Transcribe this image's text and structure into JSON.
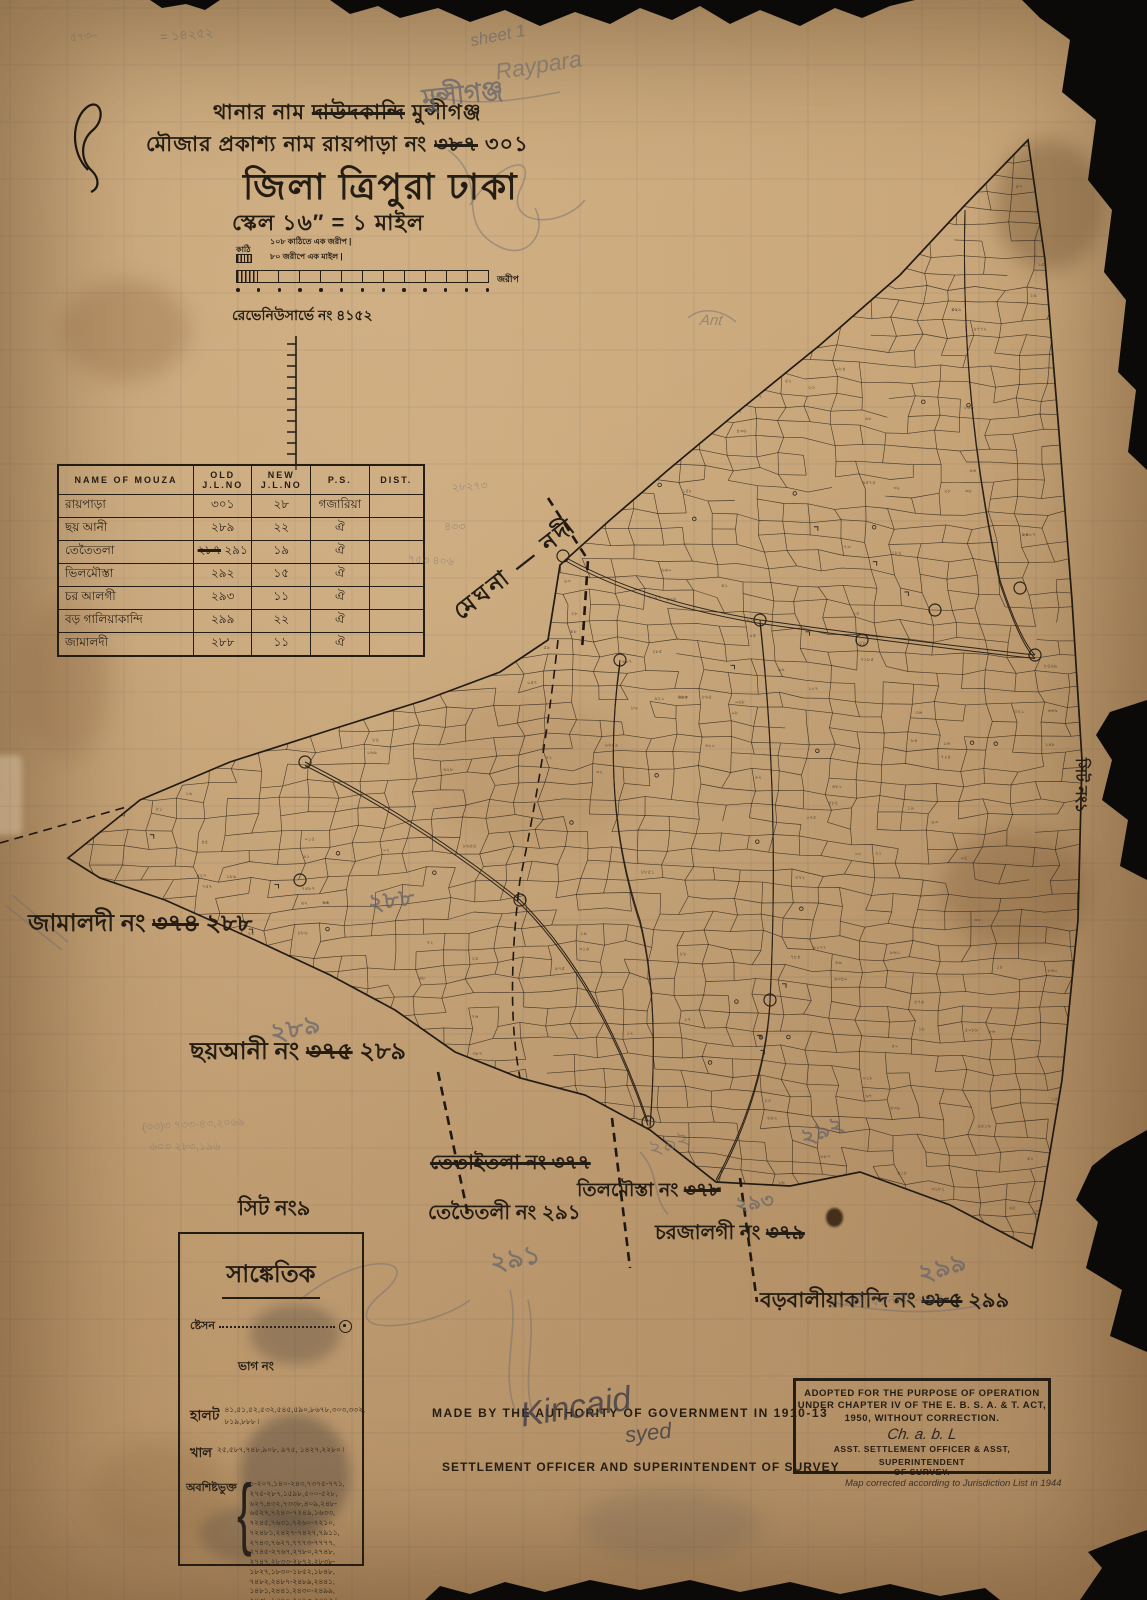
{
  "colors": {
    "paper": "#c9a77a",
    "ink": "#241d14",
    "pencil": "#63646c",
    "torn_edge": "#0b0a08"
  },
  "header": {
    "line1_prefix": "থানার নাম",
    "line1_struck": "দাউদকান্দি",
    "line1_suffix": "মুন্সীগঞ্জ",
    "line2_prefix": "মৌজার প্রকাশ্য নাম  রায়পাড়া নং",
    "line2_struck": "৩৮৭",
    "line2_suffix": "৩০১",
    "line3_prefix": "জিলা",
    "line3_mid": "ত্রিপুরা",
    "line3_suffix": "ঢাকা",
    "line4": "স্কেল ১৬″ = ১ মাইল"
  },
  "scale_bar": {
    "caption1": "১০৮ কাঠিতে এক জরীপ   |",
    "caption2": "৮০ জরীপে এক মাইল   |",
    "left_label": "কাঠি",
    "right_label": "জরীপ",
    "survey_no": "রেভেনিউসার্ভে নং ৪১৫২"
  },
  "mouza_table": {
    "headers": [
      "NAME OF MOUZA",
      "OLD J.L.NO",
      "NEW J.L.NO",
      "P.S.",
      "DIST."
    ],
    "rows": [
      {
        "name": "রায়পাড়া",
        "old": "৩০১",
        "new": "২৮",
        "ps": "গজারিয়া",
        "dist": ""
      },
      {
        "name": "ছয় আনী",
        "old": "২৮৯",
        "new": "২২",
        "ps": "ঐ",
        "dist": ""
      },
      {
        "name": "তেতৈতলা",
        "old_struck": "২৮৭",
        "old": "২৯১",
        "new": "১৯",
        "ps": "ঐ",
        "dist": ""
      },
      {
        "name": "ভিলমৌস্তা",
        "old": "২৯২",
        "new": "১৫",
        "ps": "ঐ",
        "dist": ""
      },
      {
        "name": "চর আলগী",
        "old": "২৯৩",
        "new": "১১",
        "ps": "ঐ",
        "dist": ""
      },
      {
        "name": "বড় গালিয়াকান্দি",
        "old": "২৯৯",
        "new": "২২",
        "ps": "ঐ",
        "dist": ""
      },
      {
        "name": "জামালদী",
        "old": "২৮৮",
        "new": "১১",
        "ps": "ঐ",
        "dist": ""
      }
    ]
  },
  "map_labels": {
    "river": "মেঘনা — নদী",
    "jamaldi_prefix": "জামালদী নং",
    "jamaldi_struck": "৩৭৪",
    "jamaldi_new": "২৮৮",
    "jamaldi_pencil": "২৮৮",
    "chhoyani_prefix": "ছয়আনী নং",
    "chhoyani_struck": "৩৭৫",
    "chhoyani_new": "২৮৯",
    "chhoyani_pencil": "২৮৯",
    "tetaitola_struck_all": "তেতাইতলা নং ৩৭৭",
    "tetaitoli_prefix": "তেতৈতলী নং",
    "tetaitoli_new": "২৯১",
    "tetaitoli_pencil": "২৯১",
    "tilmousta_prefix": "তিলমৌস্তা নং",
    "tilmousta_struck": "৩৭৮",
    "tilmousta_pencil": "২৯২",
    "charjalgi_prefix": "চরজালগী নং",
    "charjalgi_struck": "৩৭৯",
    "charjalgi_pencil": "২৯৩",
    "borobalia_prefix": "বড়বালীয়াকান্দি নং",
    "borobalia_struck": "৩৮৫",
    "borobalia_new": "২৯৯",
    "borobalia_pencil": "২৯৯",
    "sheet_no": "সিট নং৯",
    "edge_sheet_no": "সিট নং১"
  },
  "legend": {
    "title": "সাঙ্কেতিক",
    "station_label": "ষ্টেসন",
    "bhag_label": "ভাগ নং",
    "halot_label": "হালট",
    "halot_values": "৪১,৫১,৫২,৫৩২,৫৪৫,৫৯০,৮৬৭৮,৩০৩,৩৩২, ৮১৯,৮৮৮ ৷",
    "khal_label": "খাল",
    "khal_values": "২৫,৫৮৭,৭৪৮,৯০৮, ৯৭৫, ১৪২৭,২২৮০  ৷",
    "listed_label": "অবশিষ্টভুক্ত",
    "listed_lines": [
      "১-২০৭,১৪০-২৪৩,৭৩৭৫-৭৭১,",
      "২৭৫-২৮৭,১৫৯৮,৫০০-৫২৮,",
      "৬২৭,৪৩২,৭৩৩৮,৪০৯,২৪৮-",
      "৬৫২৭,৭২৪০-৭২৪৯,১৬৩৩,",
      "৭২৪৫,৭৬৩১,৭২৬০-৭২১০,",
      "৭২৪৮১,২৪২৭-৭৪২৭,৭৯১১,",
      "২৭৪৩,৭৬২৭,৭৭৭৩-৭৭৭৭,",
      "২৭৪৫-২৭৬৭,২৭৮০,২৭৪৮,",
      "২৭৪৭,২৮৩৩-২৮৭২,২৮৩৮-",
      "১৮২৭,১৮৩০-১৮৫২,১৮৪৮,",
      "৭৪৮২,২৪৮৭-২৪৮৯,২৪৪১,",
      "১৪৮১,২৪৪১,২৪৩০-২৪৯৯,",
      "২৪৩৮-১৪৭০,২৪৭৩-২৪৭২ ৷"
    ]
  },
  "footer": {
    "made_by": "MADE BY THE AUTHORITY OF GOVERNMENT IN 1910-13",
    "officer_line": "SETTLEMENT OFFICER AND SUPERINTENDENT OF SURVEY",
    "signature1": "Kincaid",
    "signature2": "syed"
  },
  "stamp": {
    "line1": "ADOPTED FOR THE PURPOSE OF OPERATION",
    "line2": "UNDER CHAPTER IV OF THE E. B. S. A. & T. ACT,",
    "line3": "1950, WITHOUT CORRECTION.",
    "signature": "Ch. a. b. L",
    "line4": "ASST. SETTLEMENT OFFICER & ASST, SUPERINTENDENT",
    "line5": "OF SURVEY.",
    "correction_note": "Map corrected according to Jurisdiction List in 1944"
  },
  "pencil_notes": {
    "top_sheet": "sheet 1",
    "top_raypara": "Raypara",
    "top_munshiganj": "মুন্সীগঞ্জ",
    "tl_number": "= ১৪২৫২",
    "tl_small": "৫৭৩–",
    "ant": "Ant",
    "mid_num1": "২৮২৭৩",
    "mid_num2": "৪৩৩",
    "mid_num3": "৭৫৩ ৪০৬",
    "bl_row1": "(৩৩)৩ ৭৩৩-৪৩,২০৬৯",
    "bl_row2": "৬০৩ ২৮৩,১৯৬",
    "charjalgi_extra": "২৯২",
    "balia_note": "৫৫-নদীফিরনানী,-৩৬৫"
  }
}
